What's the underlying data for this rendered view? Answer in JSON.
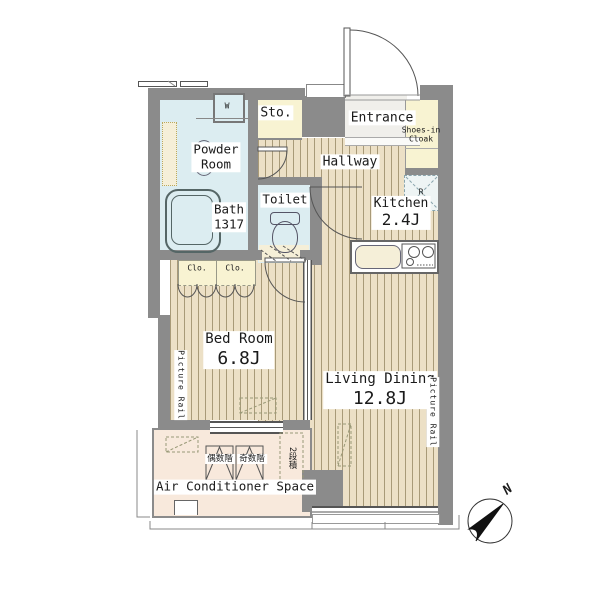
{
  "plan": {
    "title": "apartment-floor-plan",
    "rooms": {
      "storage": {
        "label": "Sto."
      },
      "entrance": {
        "label": "Entrance"
      },
      "shoes_in_cloak": {
        "line1": "Shoes-in",
        "line2": "Cloak"
      },
      "powder_room": {
        "line1": "Powder",
        "line2": "Room"
      },
      "hallway": {
        "label": "Hallway"
      },
      "bath": {
        "label": "Bath",
        "size": "1317"
      },
      "toilet": {
        "label": "Toilet"
      },
      "kitchen": {
        "label": "Kitchen",
        "size": "2.4J"
      },
      "bed_room": {
        "label": "Bed Room",
        "size": "6.8J"
      },
      "living_dining": {
        "label": "Living Dining",
        "size": "12.8J"
      },
      "air_conditioner_space": {
        "label": "Air Conditioner Space"
      },
      "closets": {
        "left": "Clo.",
        "right": "Clo."
      }
    },
    "fixtures": {
      "washing_machine": "W",
      "refrigerator": "R"
    },
    "annotations": {
      "picture_rail_left": "Picture Rail",
      "picture_rail_right": "Picture Rail",
      "ac_even_floor": "偶数階",
      "ac_odd_floor": "奇数階",
      "ac_stacked": "2段積",
      "compass_north": "N"
    },
    "colors": {
      "wall": "#8b8b8b",
      "floor_base": "#ece0c6",
      "floor_stripe": "#a89a78",
      "wet_room": "#dcedf1",
      "storage": "#f8f3d2",
      "pipe_space": "#f5efd8",
      "ac_space": "#f8e9dc",
      "entrance_floor": "#f0efeb",
      "line": "#555555"
    }
  }
}
